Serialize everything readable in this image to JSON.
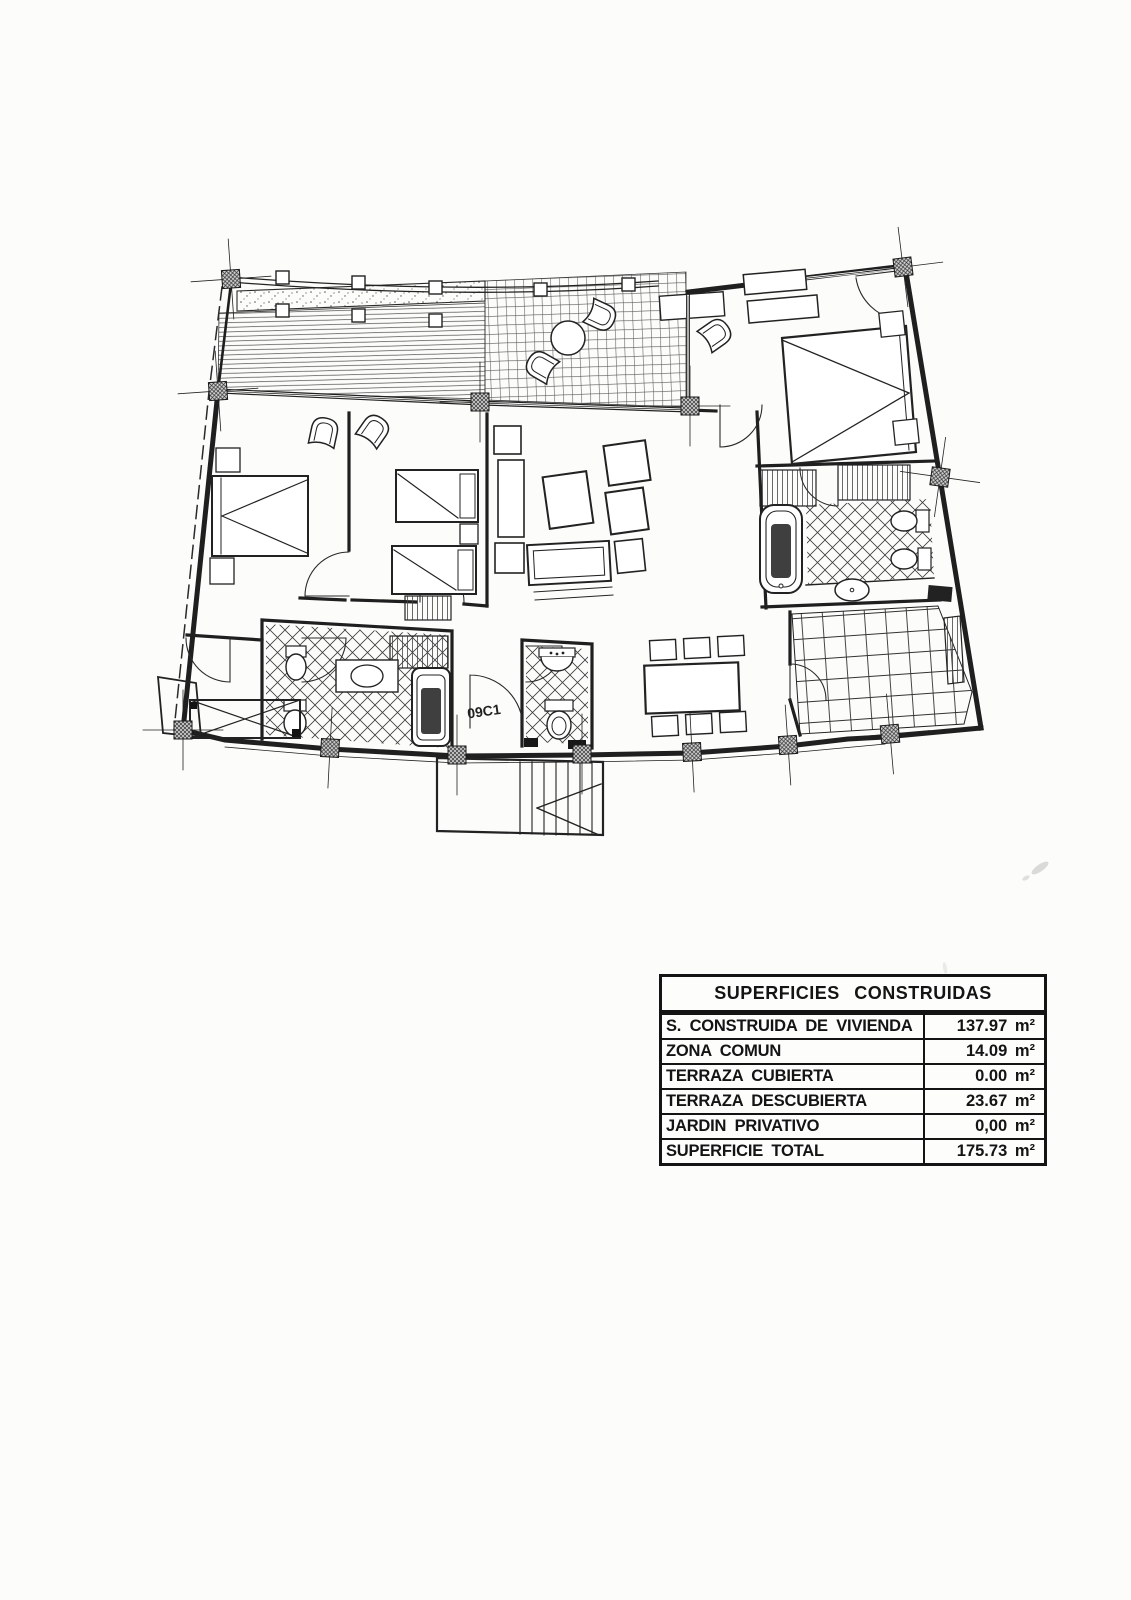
{
  "plan": {
    "unit_label": "09C1",
    "line_color": "#1f1f1f"
  },
  "areas_table": {
    "title": "SUPERFICIES CONSTRUIDAS",
    "rows": [
      {
        "label": "S. CONSTRUIDA DE VIVIENDA",
        "value": "137.97 m²"
      },
      {
        "label": "ZONA COMUN",
        "value": "14.09 m²"
      },
      {
        "label": "TERRAZA CUBIERTA",
        "value": "0.00 m²"
      },
      {
        "label": "TERRAZA DESCUBIERTA",
        "value": "23.67 m²"
      },
      {
        "label": "JARDIN PRIVATIVO",
        "value": "0,00 m²"
      },
      {
        "label": "SUPERFICIE TOTAL",
        "value": "175.73 m²"
      }
    ]
  }
}
